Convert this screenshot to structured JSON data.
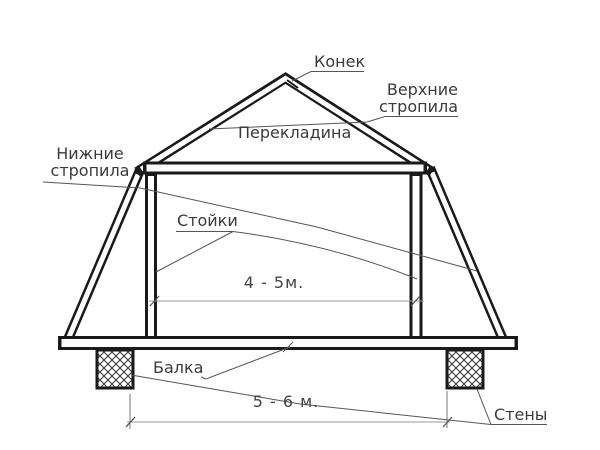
{
  "diagram": {
    "labels": {
      "ridge": "Конек",
      "upper_rafters_line1": "Верхние",
      "upper_rafters_line2": "стропила",
      "crossbar": "Перекладина",
      "lower_rafters_line1": "Нижние",
      "lower_rafters_line2": "стропила",
      "posts": "Стойки",
      "beam": "Балка",
      "walls": "Стены"
    },
    "dimensions": {
      "inner_span": "4 - 5м.",
      "outer_span": "5 - 6 м."
    },
    "colors": {
      "structure_line": "#1a1a1a",
      "leader_line": "#555555",
      "dimension_line": "#999999",
      "text": "#3a3a3a",
      "background": "#ffffff"
    }
  }
}
